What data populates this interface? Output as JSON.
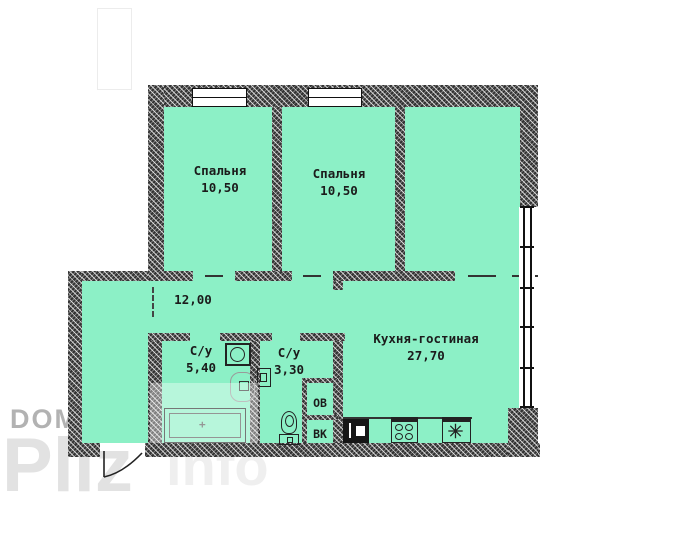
{
  "plan": {
    "rooms": {
      "bedroom1": {
        "label": "Спальня",
        "area": "10,50"
      },
      "bedroom2": {
        "label": "Спальня",
        "area": "10,50"
      },
      "hallway": {
        "area": "12,00"
      },
      "bathroom1": {
        "label": "С/у",
        "area": "5,40"
      },
      "bathroom2": {
        "label": "С/у",
        "area": "3,30"
      },
      "kitchen_living": {
        "label": "Кухня-гостиная",
        "area": "27,70"
      }
    },
    "shafts": {
      "heating_vent": "ОВ",
      "water_sewer": "ВК"
    },
    "fixtures": {
      "bathtub": "bathtub",
      "bathtub_drain_mark": "+",
      "toilet": "toilet",
      "washing_machine": "washing-machine",
      "washbasin": "washbasin",
      "kitchen_sink": "kitchen-sink",
      "stove": "stove-4-burners",
      "fridge": "fridge-snowflake",
      "entrance_door": "door-swing"
    },
    "colors": {
      "room_fill": "#8cf0c6",
      "wall": "#333333"
    }
  },
  "watermark": {
    "dom": "DOM",
    "pliz": "Pliz",
    "info": "info",
    "colors": {
      "dom": "#b2b2b2",
      "pliz": "#e2e2e2",
      "info": "#efefef"
    }
  }
}
